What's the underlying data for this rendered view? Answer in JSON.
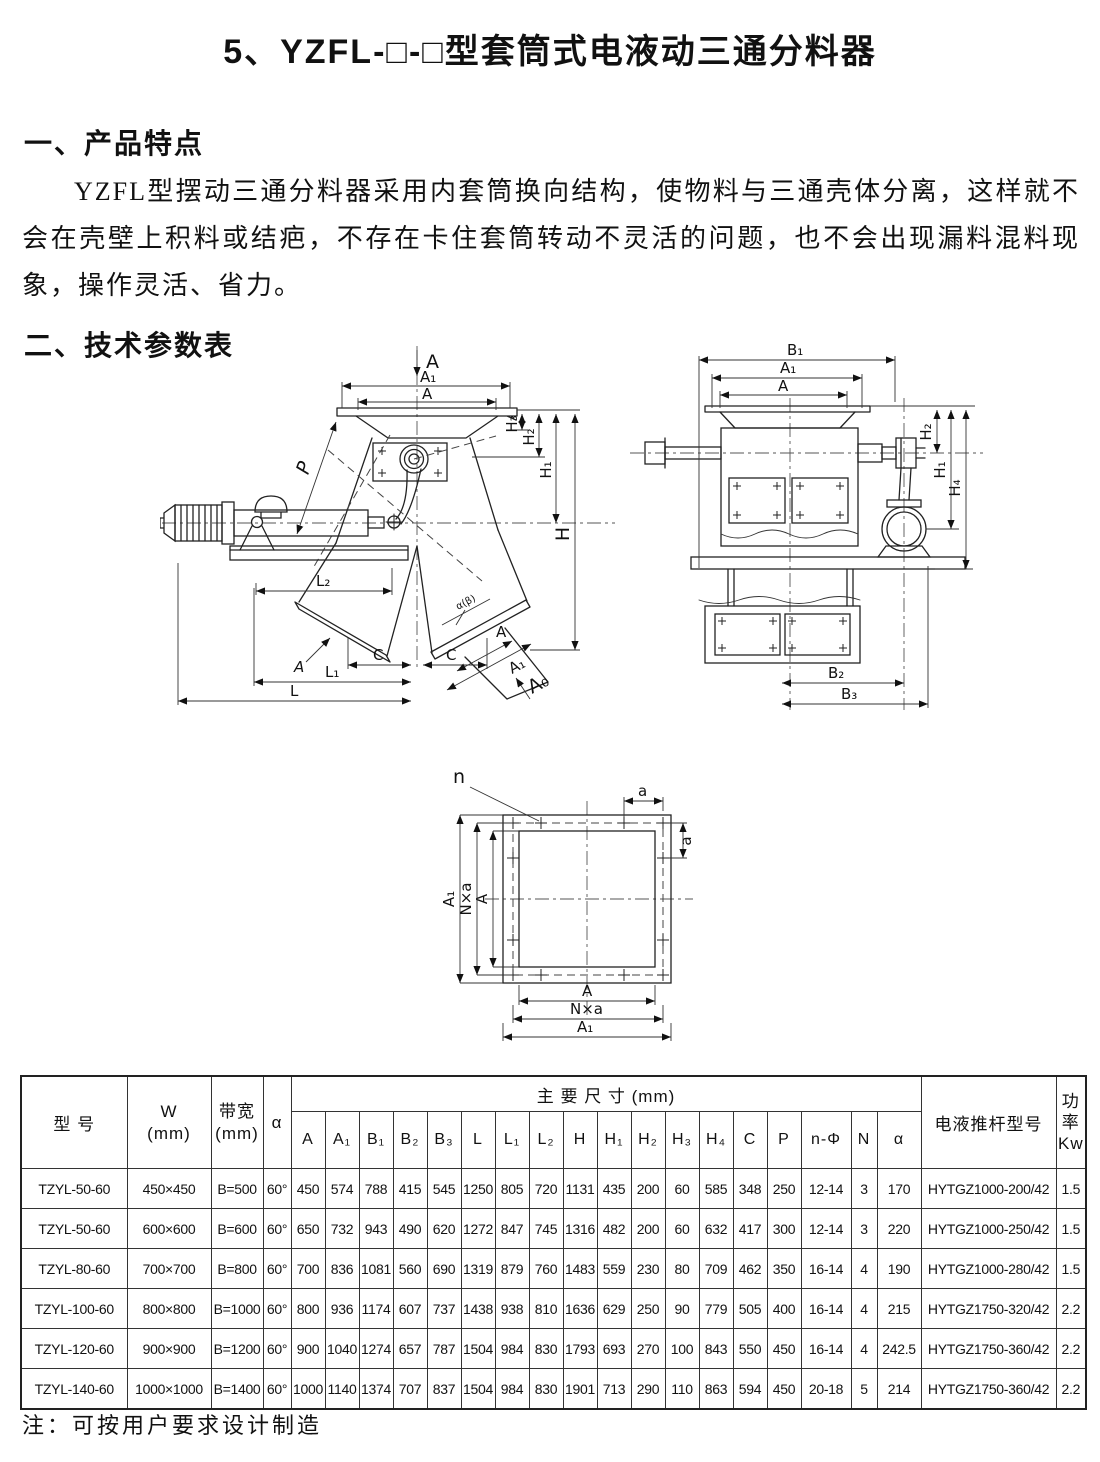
{
  "page": {
    "title": "5、YZFL-□-□型套筒式电液动三通分料器",
    "section1_heading": "一、产品特点",
    "section1_body": "YZFL型摆动三通分料器采用内套筒换向结构，使物料与三通壳体分离，这样就不会在壳壁上积料或结疤，不存在卡住套筒转动不灵活的问题，也不会出现漏料混料现象，操作灵活、省力。",
    "section2_heading": "二、技术参数表",
    "footnote": "注：可按用户要求设计制造"
  },
  "drawings": {
    "front_view": {
      "labels": {
        "feed": "A",
        "a1_top": "A₁",
        "a_top": "A",
        "h3": "H₃",
        "h2": "H₂",
        "h1": "H₁",
        "h": "H",
        "p": "P",
        "l2": "L₂",
        "l1": "L₁",
        "l": "L",
        "c_left": "C",
        "c_right": "C",
        "a_section": "A",
        "a_outlet": "A",
        "a1_outlet": "A₁",
        "a0_outlet": "A₀",
        "angle": "α(β)"
      }
    },
    "side_view": {
      "labels": {
        "b1": "B₁",
        "a1": "A₁",
        "a": "A",
        "h2": "H₂",
        "h1": "H₁",
        "h4": "H₄",
        "b2": "B₂",
        "b3": "B₃"
      }
    },
    "flange_view": {
      "labels": {
        "n": "n",
        "a_top": "a",
        "a_right": "a",
        "left_a": "A",
        "left_nxa": "N×a",
        "left_a1": "A₁",
        "bottom_a": "A",
        "bottom_nxa": "N×a",
        "bottom_a1": "A₁"
      }
    }
  },
  "table": {
    "header": {
      "model": "型  号",
      "w": "W\n(mm)",
      "bandwidth": "带宽\n(mm)",
      "alpha": "α",
      "main_dims": "主  要  尺  寸    (mm)",
      "dim_cols": [
        "A",
        "A₁",
        "B₁",
        "B₂",
        "B₃",
        "L",
        "L₁",
        "L₂",
        "H",
        "H₁",
        "H₂",
        "H₃",
        "H₄",
        "C",
        "P",
        "n-Φ",
        "N",
        "α"
      ],
      "actuator": "电液推杆型号",
      "power": "功\n率\nKw"
    },
    "rows": [
      {
        "model": "TZYL-50-60",
        "w": "450×450",
        "band": "B=500",
        "alpha": "60°",
        "dims": [
          "450",
          "574",
          "788",
          "415",
          "545",
          "1250",
          "805",
          "720",
          "1131",
          "435",
          "200",
          "60",
          "585",
          "348",
          "250",
          "12-14",
          "3",
          "170"
        ],
        "actuator": "HYTGZ1000-200/42",
        "power": "1.5"
      },
      {
        "model": "TZYL-50-60",
        "w": "600×600",
        "band": "B=600",
        "alpha": "60°",
        "dims": [
          "650",
          "732",
          "943",
          "490",
          "620",
          "1272",
          "847",
          "745",
          "1316",
          "482",
          "200",
          "60",
          "632",
          "417",
          "300",
          "12-14",
          "3",
          "220"
        ],
        "actuator": "HYTGZ1000-250/42",
        "power": "1.5"
      },
      {
        "model": "TZYL-80-60",
        "w": "700×700",
        "band": "B=800",
        "alpha": "60°",
        "dims": [
          "700",
          "836",
          "1081",
          "560",
          "690",
          "1319",
          "879",
          "760",
          "1483",
          "559",
          "230",
          "80",
          "709",
          "462",
          "350",
          "16-14",
          "4",
          "190"
        ],
        "actuator": "HYTGZ1000-280/42",
        "power": "1.5"
      },
      {
        "model": "TZYL-100-60",
        "w": "800×800",
        "band": "B=1000",
        "alpha": "60°",
        "dims": [
          "800",
          "936",
          "1174",
          "607",
          "737",
          "1438",
          "938",
          "810",
          "1636",
          "629",
          "250",
          "90",
          "779",
          "505",
          "400",
          "16-14",
          "4",
          "215"
        ],
        "actuator": "HYTGZ1750-320/42",
        "power": "2.2"
      },
      {
        "model": "TZYL-120-60",
        "w": "900×900",
        "band": "B=1200",
        "alpha": "60°",
        "dims": [
          "900",
          "1040",
          "1274",
          "657",
          "787",
          "1504",
          "984",
          "830",
          "1793",
          "693",
          "270",
          "100",
          "843",
          "550",
          "450",
          "16-14",
          "4",
          "242.5"
        ],
        "actuator": "HYTGZ1750-360/42",
        "power": "2.2"
      },
      {
        "model": "TZYL-140-60",
        "w": "1000×1000",
        "band": "B=1400",
        "alpha": "60°",
        "dims": [
          "1000",
          "1140",
          "1374",
          "707",
          "837",
          "1504",
          "984",
          "830",
          "1901",
          "713",
          "290",
          "110",
          "863",
          "594",
          "450",
          "20-18",
          "5",
          "214"
        ],
        "actuator": "HYTGZ1750-360/42",
        "power": "2.2"
      }
    ]
  }
}
